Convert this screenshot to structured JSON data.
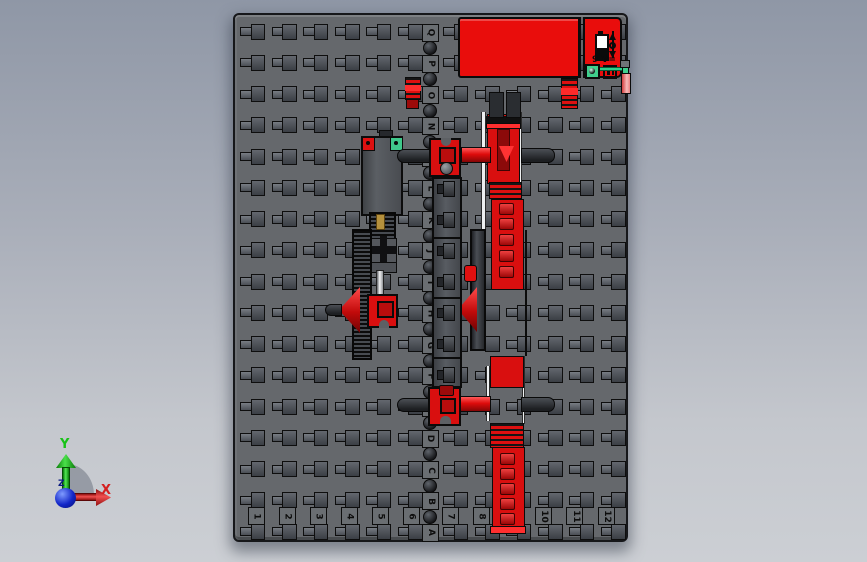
{
  "viewport": {
    "background_top": "#8f97a6",
    "background_bottom": "#cccfd4"
  },
  "triad": {
    "x_label": "X",
    "y_label": "Y",
    "z_label": "Z",
    "x_color": "#d42020",
    "y_color": "#17c217",
    "z_color": "#0a1a80"
  },
  "plate": {
    "row_labels": [
      "A",
      "B",
      "C",
      "D",
      "E",
      "F",
      "G",
      "H",
      "I",
      "J",
      "K",
      "L",
      "M",
      "N",
      "O",
      "P",
      "Q"
    ],
    "column_labels": [
      "1",
      "2",
      "3",
      "4",
      "5",
      "6",
      "7",
      "8",
      "9",
      "10",
      "11",
      "12"
    ],
    "color": "#65686c"
  },
  "battery_box": {
    "voltage_label": "9 V=",
    "icons": [
      "battery-icon",
      "switch-icon",
      "power-socket-icon",
      "ground-screw-icon"
    ],
    "body_color": "#e90d0c",
    "connector_color": "#3fcf8d",
    "wire_color": "#2fd08a"
  },
  "parts": {
    "accent_red": "#d90f0f",
    "clip_green": "#3fc98b",
    "clip_red": "#dd1111"
  }
}
